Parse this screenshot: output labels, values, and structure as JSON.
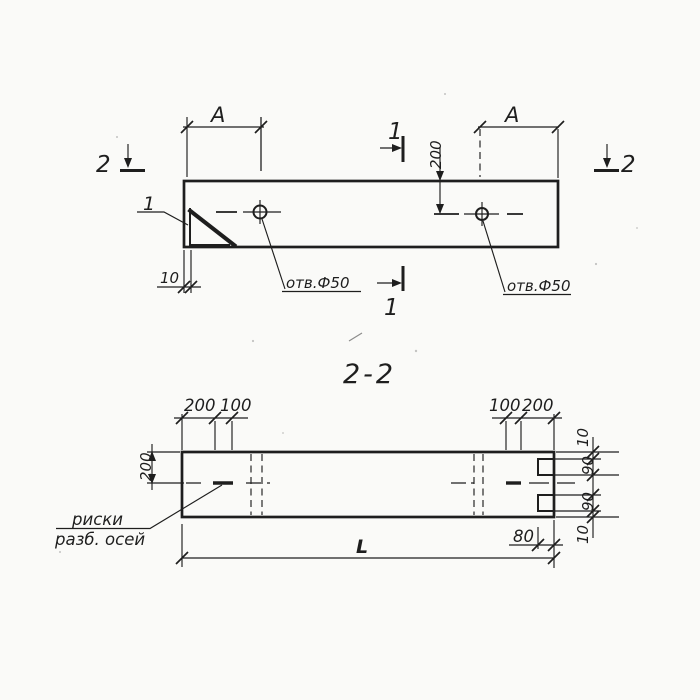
{
  "colors": {
    "ink": "#1e1e1e",
    "paper": "#fafaf8"
  },
  "plan_view": {
    "dim_a_left": "A",
    "dim_a_right": "A",
    "dim_hole_offset": "200",
    "dim_edge_thickness": "10",
    "hole_label_left": "отв.Ф50",
    "hole_label_right": "отв.Ф50",
    "section_mark_left": "2",
    "section_mark_right": "2",
    "section_mark_top": "1",
    "section_mark_bottom": "1",
    "detail_callout": "1"
  },
  "section_view": {
    "title": "2-2",
    "dims_top_left": [
      "200",
      "100"
    ],
    "dims_top_right": [
      "100",
      "200"
    ],
    "dim_height": "200",
    "dims_right_chain": [
      "10",
      "90",
      "90",
      "10"
    ],
    "dim_notch_depth": "80",
    "dim_length": "L",
    "axis_note_line1": "риски",
    "axis_note_line2": "разб. осей"
  }
}
